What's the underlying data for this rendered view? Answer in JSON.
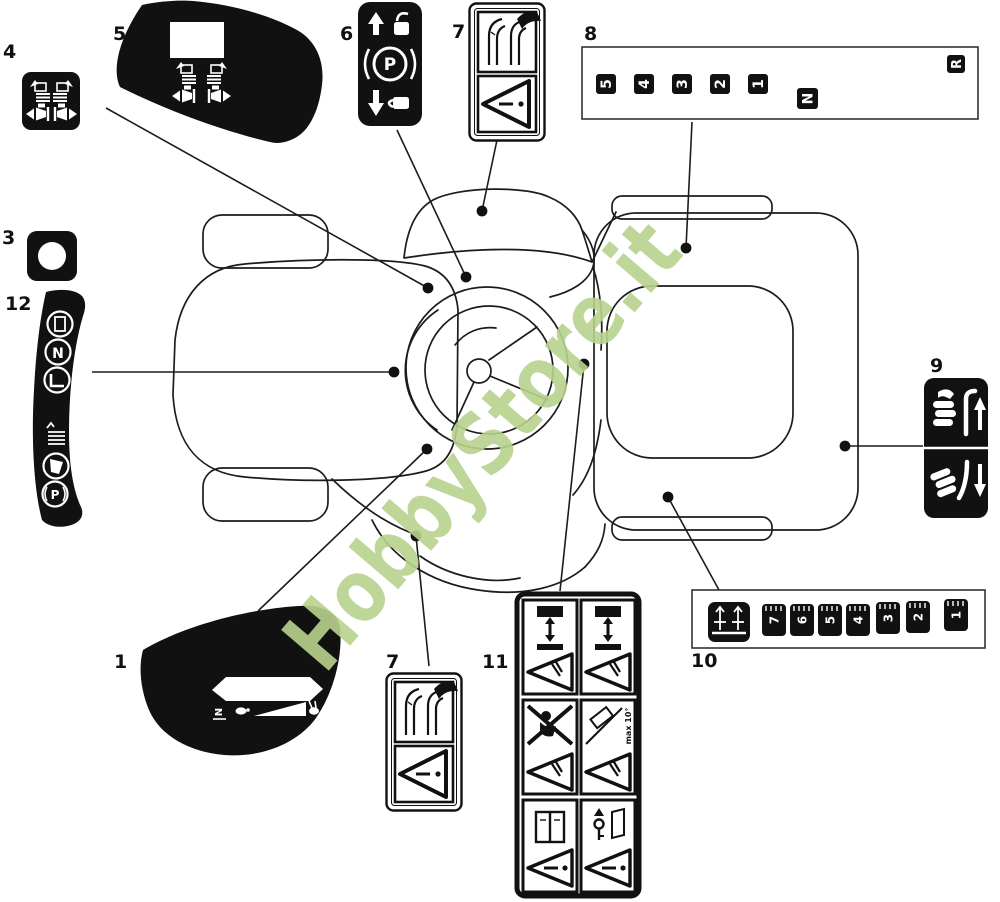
{
  "watermark": {
    "text": "HobbyStore.it",
    "color": "#b9d28e"
  },
  "callout_labels": {
    "n1": "1",
    "n3": "3",
    "n4": "4",
    "n5": "5",
    "n6": "6",
    "n7a": "7",
    "n7b": "7",
    "n8": "8",
    "n9": "9",
    "n10": "10",
    "n11": "11",
    "n12": "12"
  },
  "decal6": {
    "parking_letter": "P"
  },
  "decal8": {
    "gears": [
      "5",
      "4",
      "3",
      "2",
      "1"
    ],
    "neutral": "N",
    "reverse": "R"
  },
  "decal10": {
    "heights": [
      "7",
      "6",
      "5",
      "4",
      "3",
      "2",
      "1"
    ]
  },
  "decal11": {
    "slope_text": "max 10°"
  },
  "decal12": {
    "neutral": "N",
    "parking": "P"
  },
  "decal1": {
    "neutral": "N"
  },
  "icons": {
    "decal3": "keyhole-dot-icon",
    "decal4": "side-discharge-left-right-icons",
    "decal5": "dashboard-panel-discharge-icons",
    "decal6": "unlock-up-parking-brake-lock-down-icons",
    "decal7": "lever-hook-warning-triangle-icons",
    "decal9": "grass-catcher-lever-up-down-icons",
    "decal10": "cutting-height-icon",
    "decal11": "blade-no-passenger-slope-manual-key-warning-icons",
    "decal12": "window-neutral-seat-grass-bag-parking-icons",
    "decal1": "throttle-turtle-rabbit-icons"
  }
}
